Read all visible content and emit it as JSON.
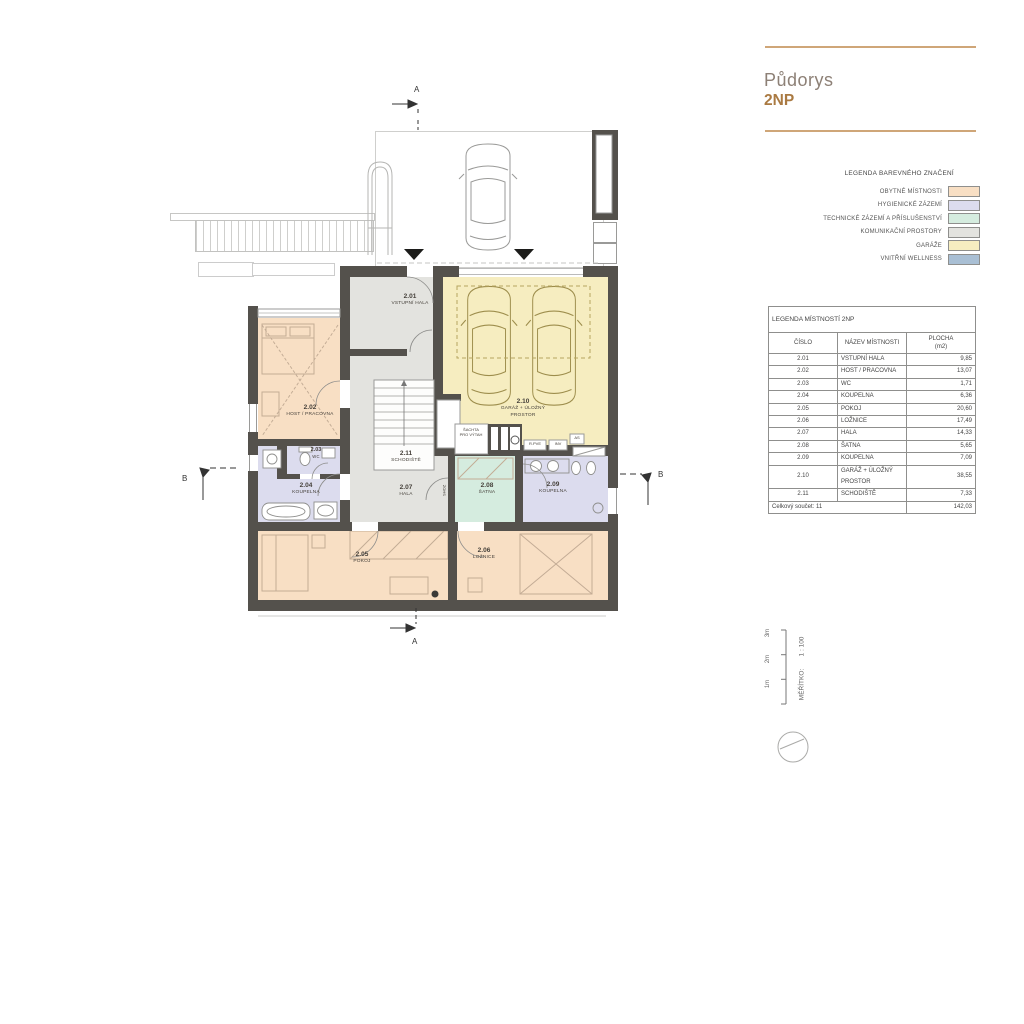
{
  "title": {
    "name": "Půdorys",
    "floor": "2NP"
  },
  "color_legend": {
    "header": "LEGENDA BAREVNÉHO ZNAČENÍ",
    "items": [
      {
        "label": "OBYTNÉ MÍSTNOSTI",
        "color": "#f8dfc4"
      },
      {
        "label": "HYGIENICKÉ ZÁZEMÍ",
        "color": "#dcdcee"
      },
      {
        "label": "TECHNICKÉ ZÁZEMÍ A PŘÍSLUŠENSTVÍ",
        "color": "#d5ecdf"
      },
      {
        "label": "KOMUNIKAČNÍ PROSTORY",
        "color": "#e3e3df"
      },
      {
        "label": "GARÁŽE",
        "color": "#f6edc0"
      },
      {
        "label": "VNITŘNÍ WELLNESS",
        "color": "#a9bfd4"
      }
    ]
  },
  "room_table": {
    "title": "LEGENDA MÍSTNOSTÍ 2NP",
    "col_cislo": "ČÍSLO",
    "col_nazev": "NÁZEV MÍSTNOSTI",
    "col_plocha_1": "PLOCHA",
    "col_plocha_2": "(m2)",
    "rows": [
      {
        "cislo": "2.01",
        "nazev": "VSTUPNÍ HALA",
        "plocha": "9,85"
      },
      {
        "cislo": "2.02",
        "nazev": "HOST / PRACOVNA",
        "plocha": "13,07"
      },
      {
        "cislo": "2.03",
        "nazev": "WC",
        "plocha": "1,71"
      },
      {
        "cislo": "2.04",
        "nazev": "KOUPELNA",
        "plocha": "6,36"
      },
      {
        "cislo": "2.05",
        "nazev": "POKOJ",
        "plocha": "20,60"
      },
      {
        "cislo": "2.06",
        "nazev": "LOŽNICE",
        "plocha": "17,49"
      },
      {
        "cislo": "2.07",
        "nazev": "HALA",
        "plocha": "14,33"
      },
      {
        "cislo": "2.08",
        "nazev": "ŠATNA",
        "plocha": "5,65"
      },
      {
        "cislo": "2.09",
        "nazev": "KOUPELNA",
        "plocha": "7,09"
      },
      {
        "cislo": "2.10",
        "nazev": "GARÁŽ + ÚLOŽNÝ PROSTOR",
        "plocha": "38,55"
      },
      {
        "cislo": "2.11",
        "nazev": "SCHODIŠTĚ",
        "plocha": "7,33"
      }
    ],
    "total_label": "Celkový součet: 11",
    "total_value": "142,03"
  },
  "plan": {
    "rooms": [
      {
        "num": "2.01",
        "name": "VSTUPNÍ HALA"
      },
      {
        "num": "2.02",
        "name": "HOST / PRACOVNA"
      },
      {
        "num": "2.03",
        "name": "WC"
      },
      {
        "num": "2.04",
        "name": "KOUPELNA"
      },
      {
        "num": "2.05",
        "name": "POKOJ"
      },
      {
        "num": "2.06",
        "name": "LOŽNICE"
      },
      {
        "num": "2.07",
        "name": "HALA"
      },
      {
        "num": "2.08",
        "name": "ŠATNA"
      },
      {
        "num": "2.09",
        "name": "KOUPELNA"
      },
      {
        "num": "2.10",
        "name": "GARÁŽ + ÚLOŽNÝ",
        "name2": "PROSTOR"
      },
      {
        "num": "2.11",
        "name": "SCHODIŠTĚ"
      }
    ],
    "annotations": {
      "shaft_line1": "ŠACHTA",
      "shaft_line2": "PRO VÝTAH",
      "rpve": "R.PVE",
      "inv": "INV",
      "as": "AS",
      "shoz": "SHOZ"
    },
    "section_a": "A",
    "section_b": "B"
  },
  "scale_bar": {
    "label": "MĚŘÍTKO:",
    "ratio": "1 : 100",
    "ticks": [
      "1m",
      "2m",
      "3m"
    ]
  },
  "wall_color": "#54514c"
}
